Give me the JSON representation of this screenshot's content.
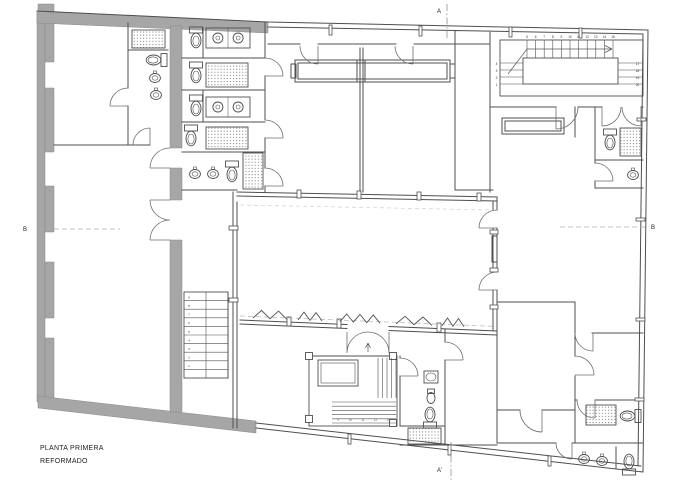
{
  "title": {
    "line1": "PLANTA PRIMERA",
    "line2": "REFORMADO"
  },
  "section_markers": {
    "a_top": "A",
    "a_bottom": "A'",
    "b_left": "B",
    "b_right": "B"
  },
  "colors": {
    "masonry_wall": "#a6a6a6",
    "masonry_edge": "#8a8a8a",
    "wall_line": "#4f4f4f",
    "door_line": "#6e6e6e",
    "dash_line": "#adadad",
    "hatch_dot": "#777777",
    "text": "#1c1c1c",
    "stair_number": "#333333",
    "background": "#ffffff"
  },
  "stairs": {
    "upper_right": {
      "top_numbers": [
        "5",
        "6",
        "7",
        "8",
        "9",
        "10",
        "11",
        "12",
        "13",
        "14",
        "15"
      ],
      "left_numbers": [
        "4",
        "3",
        "2",
        "1"
      ],
      "right_numbers": [
        "17",
        "18",
        "19",
        "20"
      ]
    },
    "left": {
      "numbers": [
        "9",
        "8",
        "7",
        "6",
        "5",
        "4",
        "3",
        "2",
        "1"
      ]
    },
    "lower_center": {
      "numbers": [
        "9",
        "10",
        "11",
        "12",
        "13"
      ]
    }
  },
  "fixtures": [
    {
      "type": "shower",
      "name": "shower-tray",
      "x": 132,
      "y": 30,
      "w": 33,
      "h": 18
    },
    {
      "type": "toilet",
      "name": "toilet",
      "x": 154,
      "y": 60,
      "rot": 90
    },
    {
      "type": "basin",
      "name": "washbasin",
      "x": 155,
      "y": 78
    },
    {
      "type": "basin",
      "name": "washbasin",
      "x": 156,
      "y": 95
    },
    {
      "type": "toilet",
      "name": "toilet",
      "x": 196,
      "y": 40,
      "rot": 0
    },
    {
      "type": "counter2",
      "name": "double-sink-counter",
      "x": 206,
      "y": 28,
      "w": 44,
      "h": 20
    },
    {
      "type": "toilet",
      "name": "toilet",
      "x": 196,
      "y": 75,
      "rot": 0
    },
    {
      "type": "shower",
      "name": "shower-tray",
      "x": 206,
      "y": 63,
      "w": 42,
      "h": 24
    },
    {
      "type": "toilet",
      "name": "toilet",
      "x": 196,
      "y": 108,
      "rot": 0
    },
    {
      "type": "counter2",
      "name": "double-sink-counter",
      "x": 206,
      "y": 97,
      "w": 44,
      "h": 20
    },
    {
      "type": "toilet",
      "name": "toilet",
      "x": 191,
      "y": 138,
      "rot": 0
    },
    {
      "type": "shower",
      "name": "shower-tray",
      "x": 206,
      "y": 127,
      "w": 42,
      "h": 22
    },
    {
      "type": "basin",
      "name": "washbasin",
      "x": 195,
      "y": 174
    },
    {
      "type": "basin",
      "name": "washbasin",
      "x": 213,
      "y": 174
    },
    {
      "type": "toilet",
      "name": "toilet",
      "x": 232,
      "y": 174,
      "rot": 0
    },
    {
      "type": "shower",
      "name": "shower-tray",
      "x": 243,
      "y": 153,
      "w": 20,
      "h": 36
    },
    {
      "type": "toilet",
      "name": "toilet",
      "x": 610,
      "y": 142,
      "rot": 0
    },
    {
      "type": "shower",
      "name": "shower-tray",
      "x": 620,
      "y": 128,
      "w": 21,
      "h": 28
    },
    {
      "type": "basin",
      "name": "washbasin",
      "x": 633,
      "y": 175
    },
    {
      "type": "sink",
      "name": "washbasin",
      "x": 424,
      "y": 371,
      "w": 14,
      "h": 12
    },
    {
      "type": "bidet",
      "name": "bidet",
      "x": 431,
      "y": 398
    },
    {
      "type": "toilet",
      "name": "toilet",
      "x": 430,
      "y": 415,
      "rot": 180
    },
    {
      "type": "shower",
      "name": "shower-tray",
      "x": 408,
      "y": 428,
      "w": 33,
      "h": 16
    },
    {
      "type": "shower",
      "name": "shower-tray",
      "x": 586,
      "y": 405,
      "w": 30,
      "h": 20
    },
    {
      "type": "toilet",
      "name": "toilet",
      "x": 628,
      "y": 416,
      "rot": 90
    },
    {
      "type": "basin",
      "name": "washbasin",
      "x": 584,
      "y": 459
    },
    {
      "type": "basin",
      "name": "washbasin",
      "x": 602,
      "y": 461
    },
    {
      "type": "toilet",
      "name": "toilet",
      "x": 629,
      "y": 462,
      "rot": 180
    }
  ],
  "folding_partitions": [
    {
      "x": 253,
      "w": 34,
      "peaks": 2
    },
    {
      "x": 298,
      "w": 24,
      "peaks": 2
    },
    {
      "x": 340,
      "w": 40,
      "peaks": 3
    },
    {
      "x": 396,
      "w": 36,
      "peaks": 2
    },
    {
      "x": 442,
      "w": 22,
      "peaks": 2
    }
  ]
}
